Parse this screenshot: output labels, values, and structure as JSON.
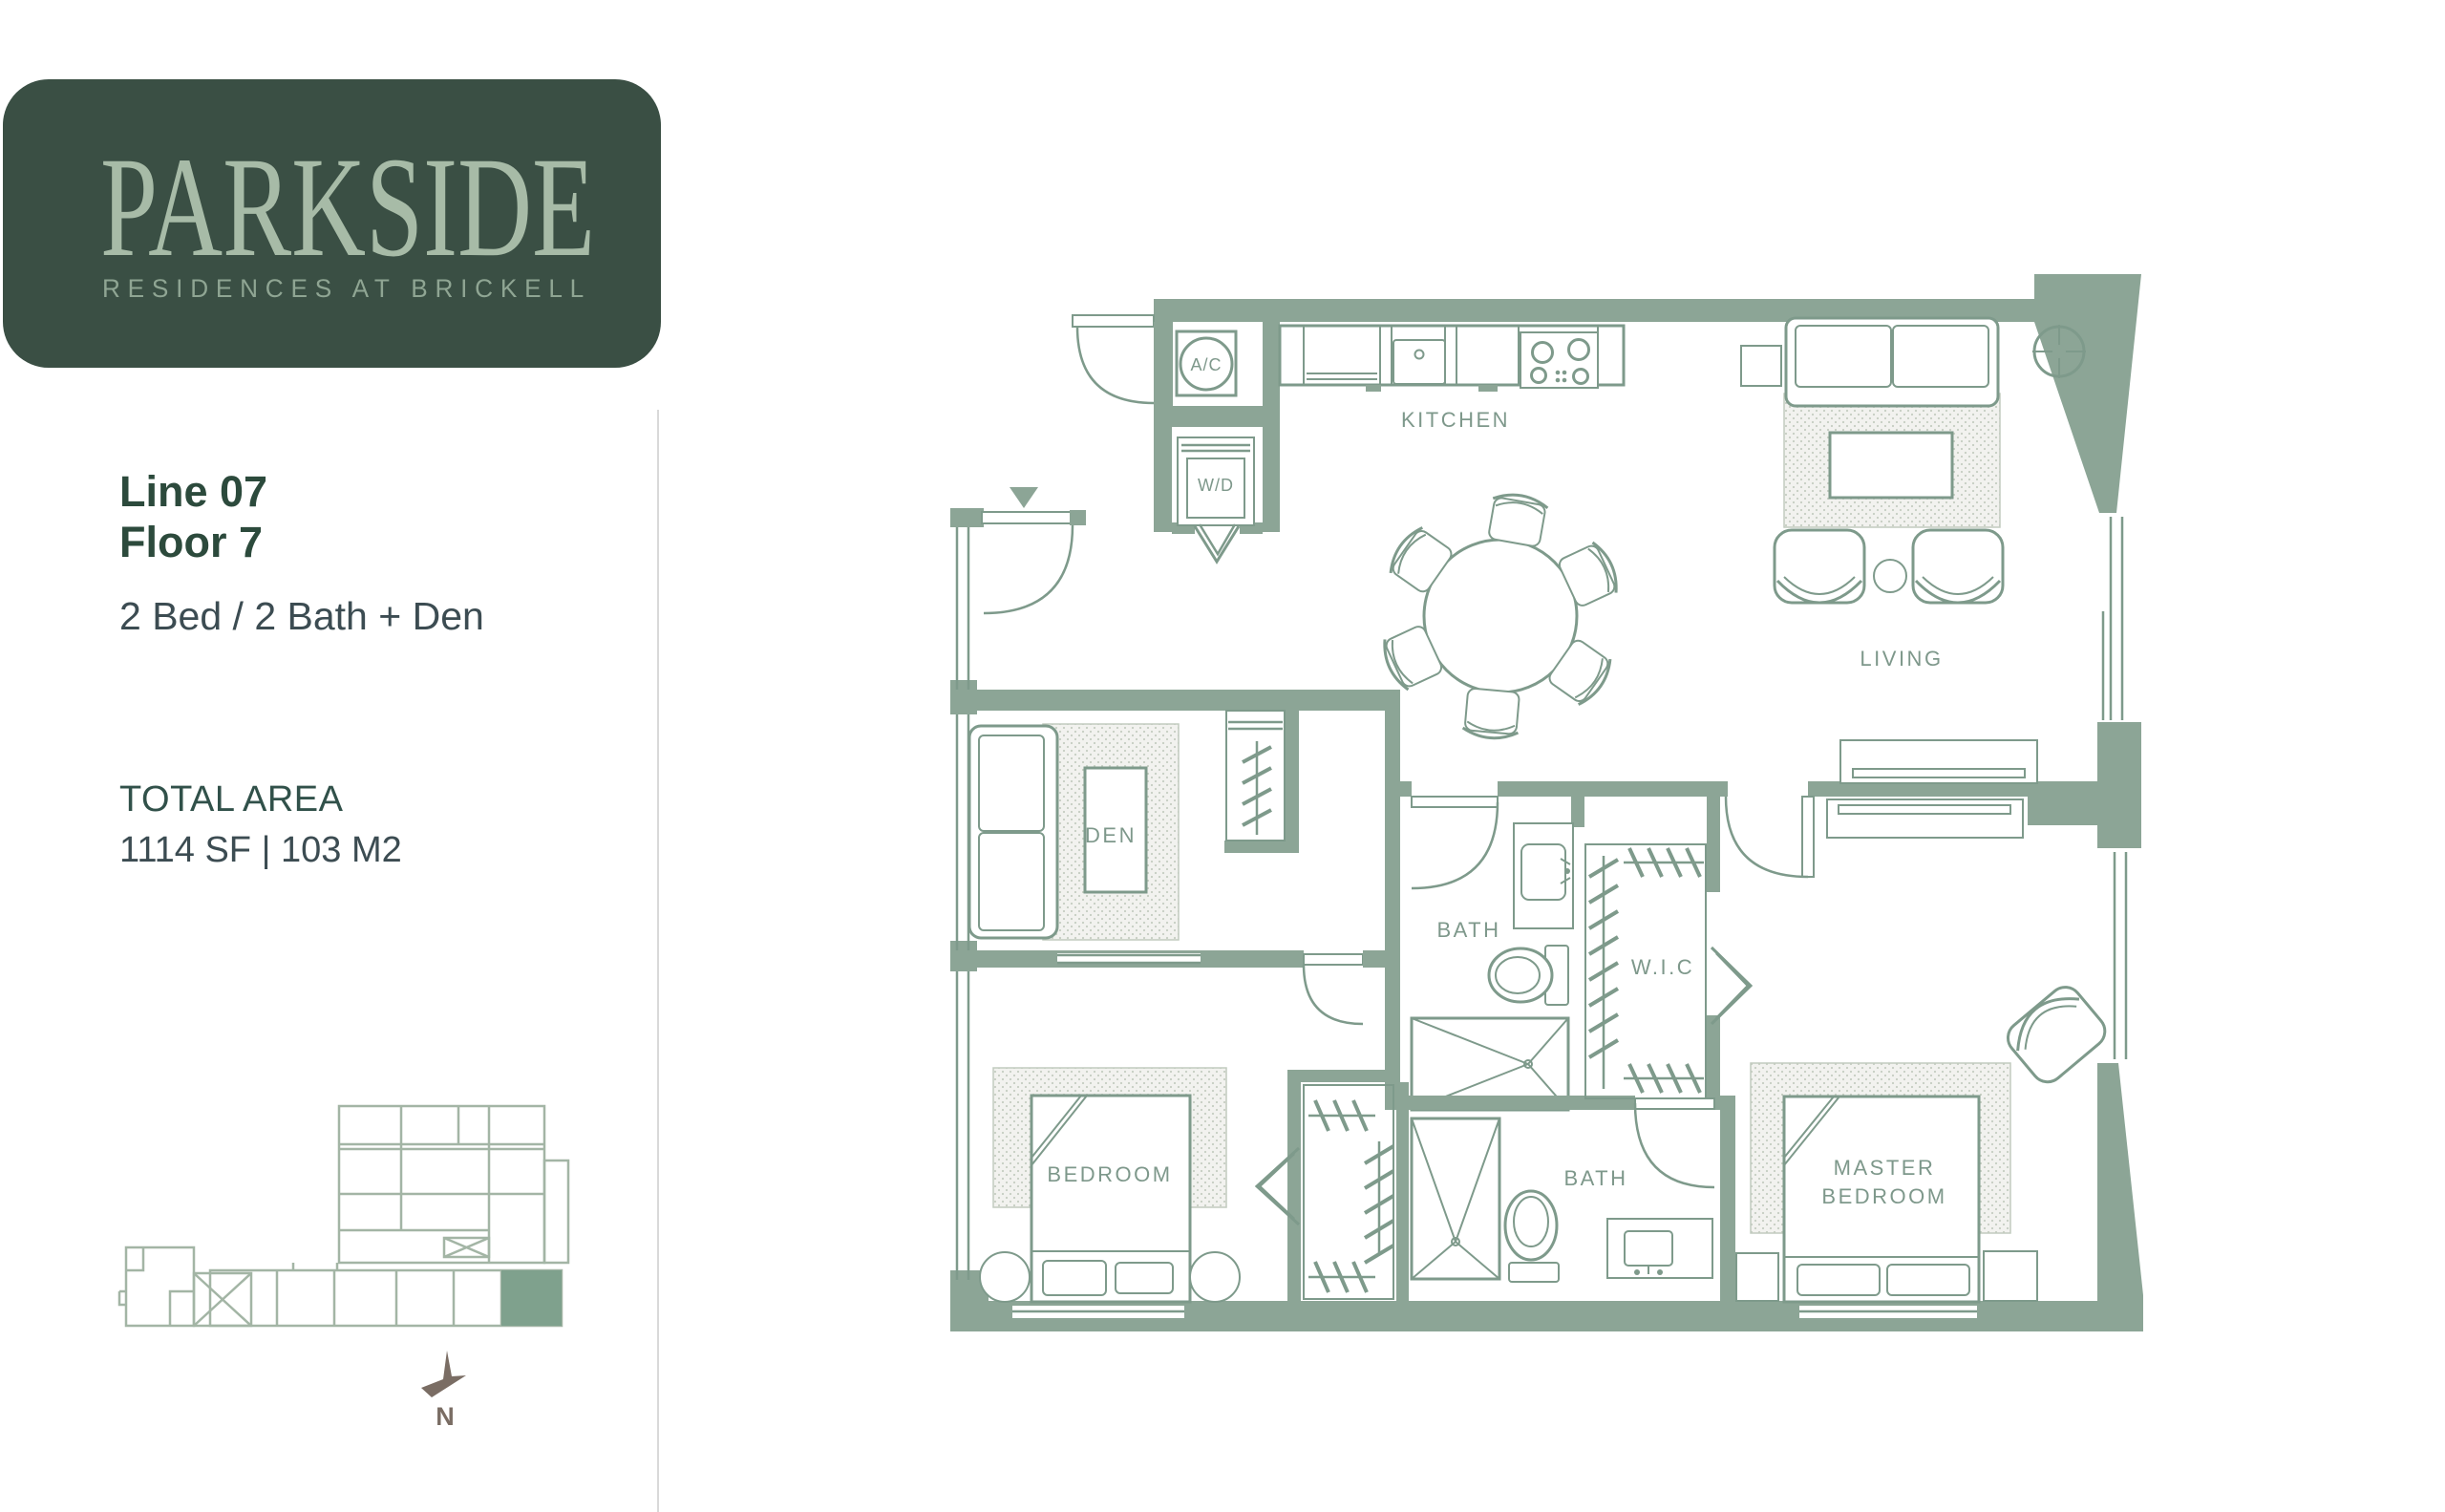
{
  "brand": {
    "name": "PARKSIDE",
    "tagline": "RESIDENCES AT BRICKELL"
  },
  "unit": {
    "line_label": "Line 07",
    "floor_label": "Floor 7",
    "configuration": "2 Bed / 2 Bath + Den",
    "total_area_label": "TOTAL AREA",
    "total_area_value": "1114 SF | 103 M2"
  },
  "floorplan": {
    "labels": {
      "kitchen": "KITCHEN",
      "living": "LIVING",
      "den": "DEN",
      "bath_upper": "BATH",
      "wic": "W.I.C",
      "bedroom": "BEDROOM",
      "bath_lower": "BATH",
      "master_line1": "MASTER",
      "master_line2": "BEDROOM"
    },
    "closets": {
      "ac": "A/C",
      "wd": "W/D"
    },
    "compass_label": "N"
  },
  "colors": {
    "logo_bg": "#3A4F44",
    "logo_text": "#A7BBA7",
    "logo_sub": "#8FA593",
    "heading": "#2C4A3C",
    "subheading": "#31514A",
    "body": "#3C4C52",
    "wall": "#8CA596",
    "line": "#7E9A8B",
    "label": "#7E988B",
    "keyplan": "#A3B5A5",
    "highlight": "#7FA18D",
    "north": "#7A6D64",
    "divider": "#D9D9D9",
    "rug_dot": "#C5CDC2"
  }
}
